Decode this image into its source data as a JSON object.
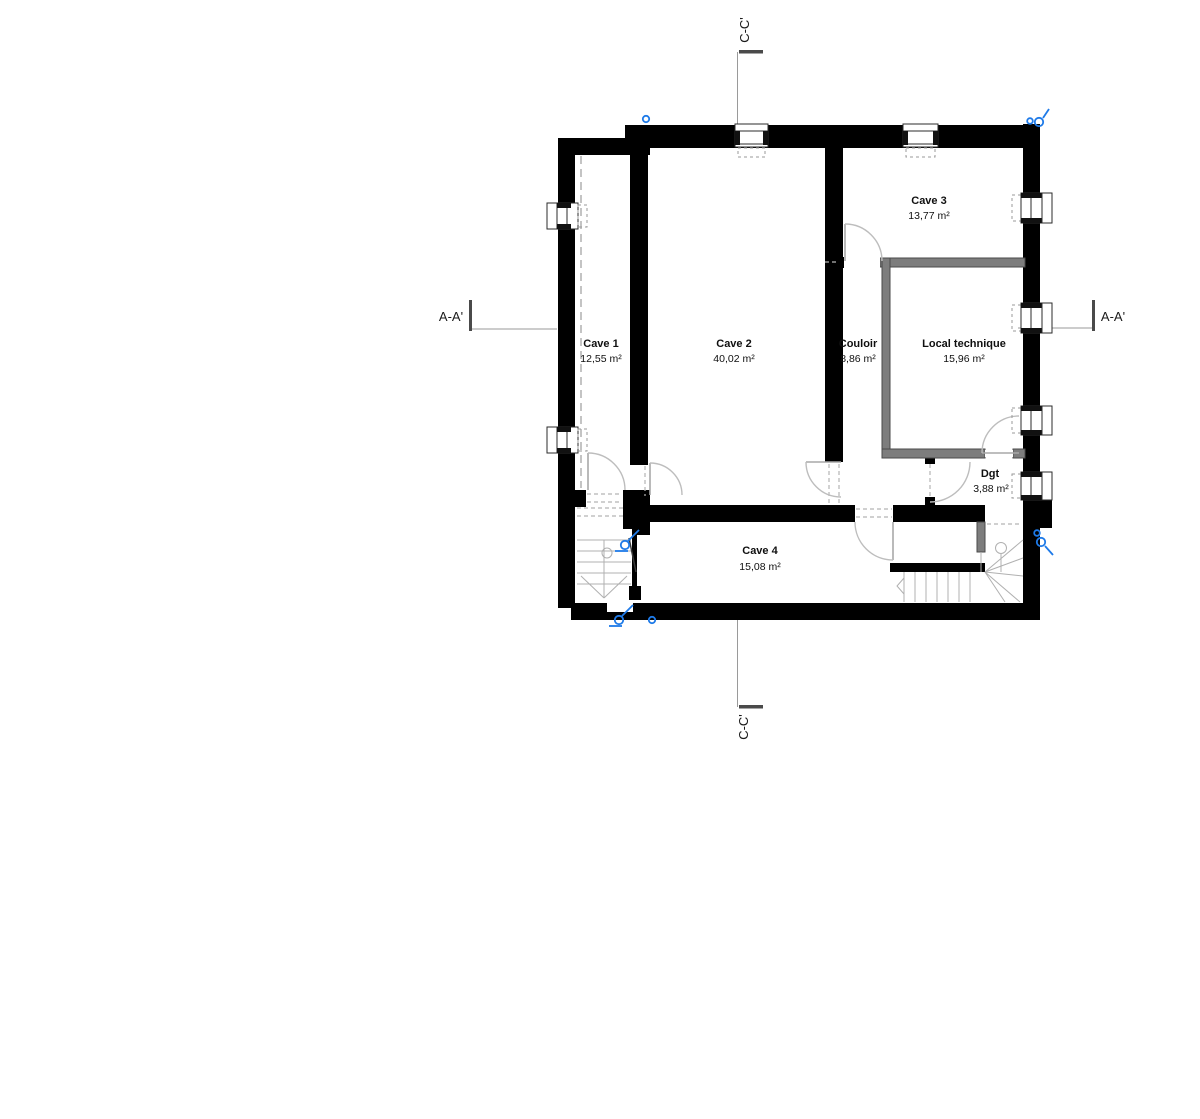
{
  "plan": {
    "rooms": [
      {
        "name": "Cave 1",
        "area": "12,55 m²"
      },
      {
        "name": "Cave 2",
        "area": "40,02 m²"
      },
      {
        "name": "Cave 3",
        "area": "13,77 m²"
      },
      {
        "name": "Couloir",
        "area": "8,86 m²"
      },
      {
        "name": "Local technique",
        "area": "15,96 m²"
      },
      {
        "name": "Dgt",
        "area": "3,88 m²"
      },
      {
        "name": "Cave 4",
        "area": "15,08 m²"
      }
    ],
    "section_markers": {
      "aa": "A-A'",
      "cc": "C-C'"
    },
    "colors": {
      "wall": "#000000",
      "partition_wall": "#7d7d7d",
      "drawing_line": "#9a9a9a",
      "marker_blue": "#1e7ae8",
      "background": "#ffffff"
    }
  }
}
